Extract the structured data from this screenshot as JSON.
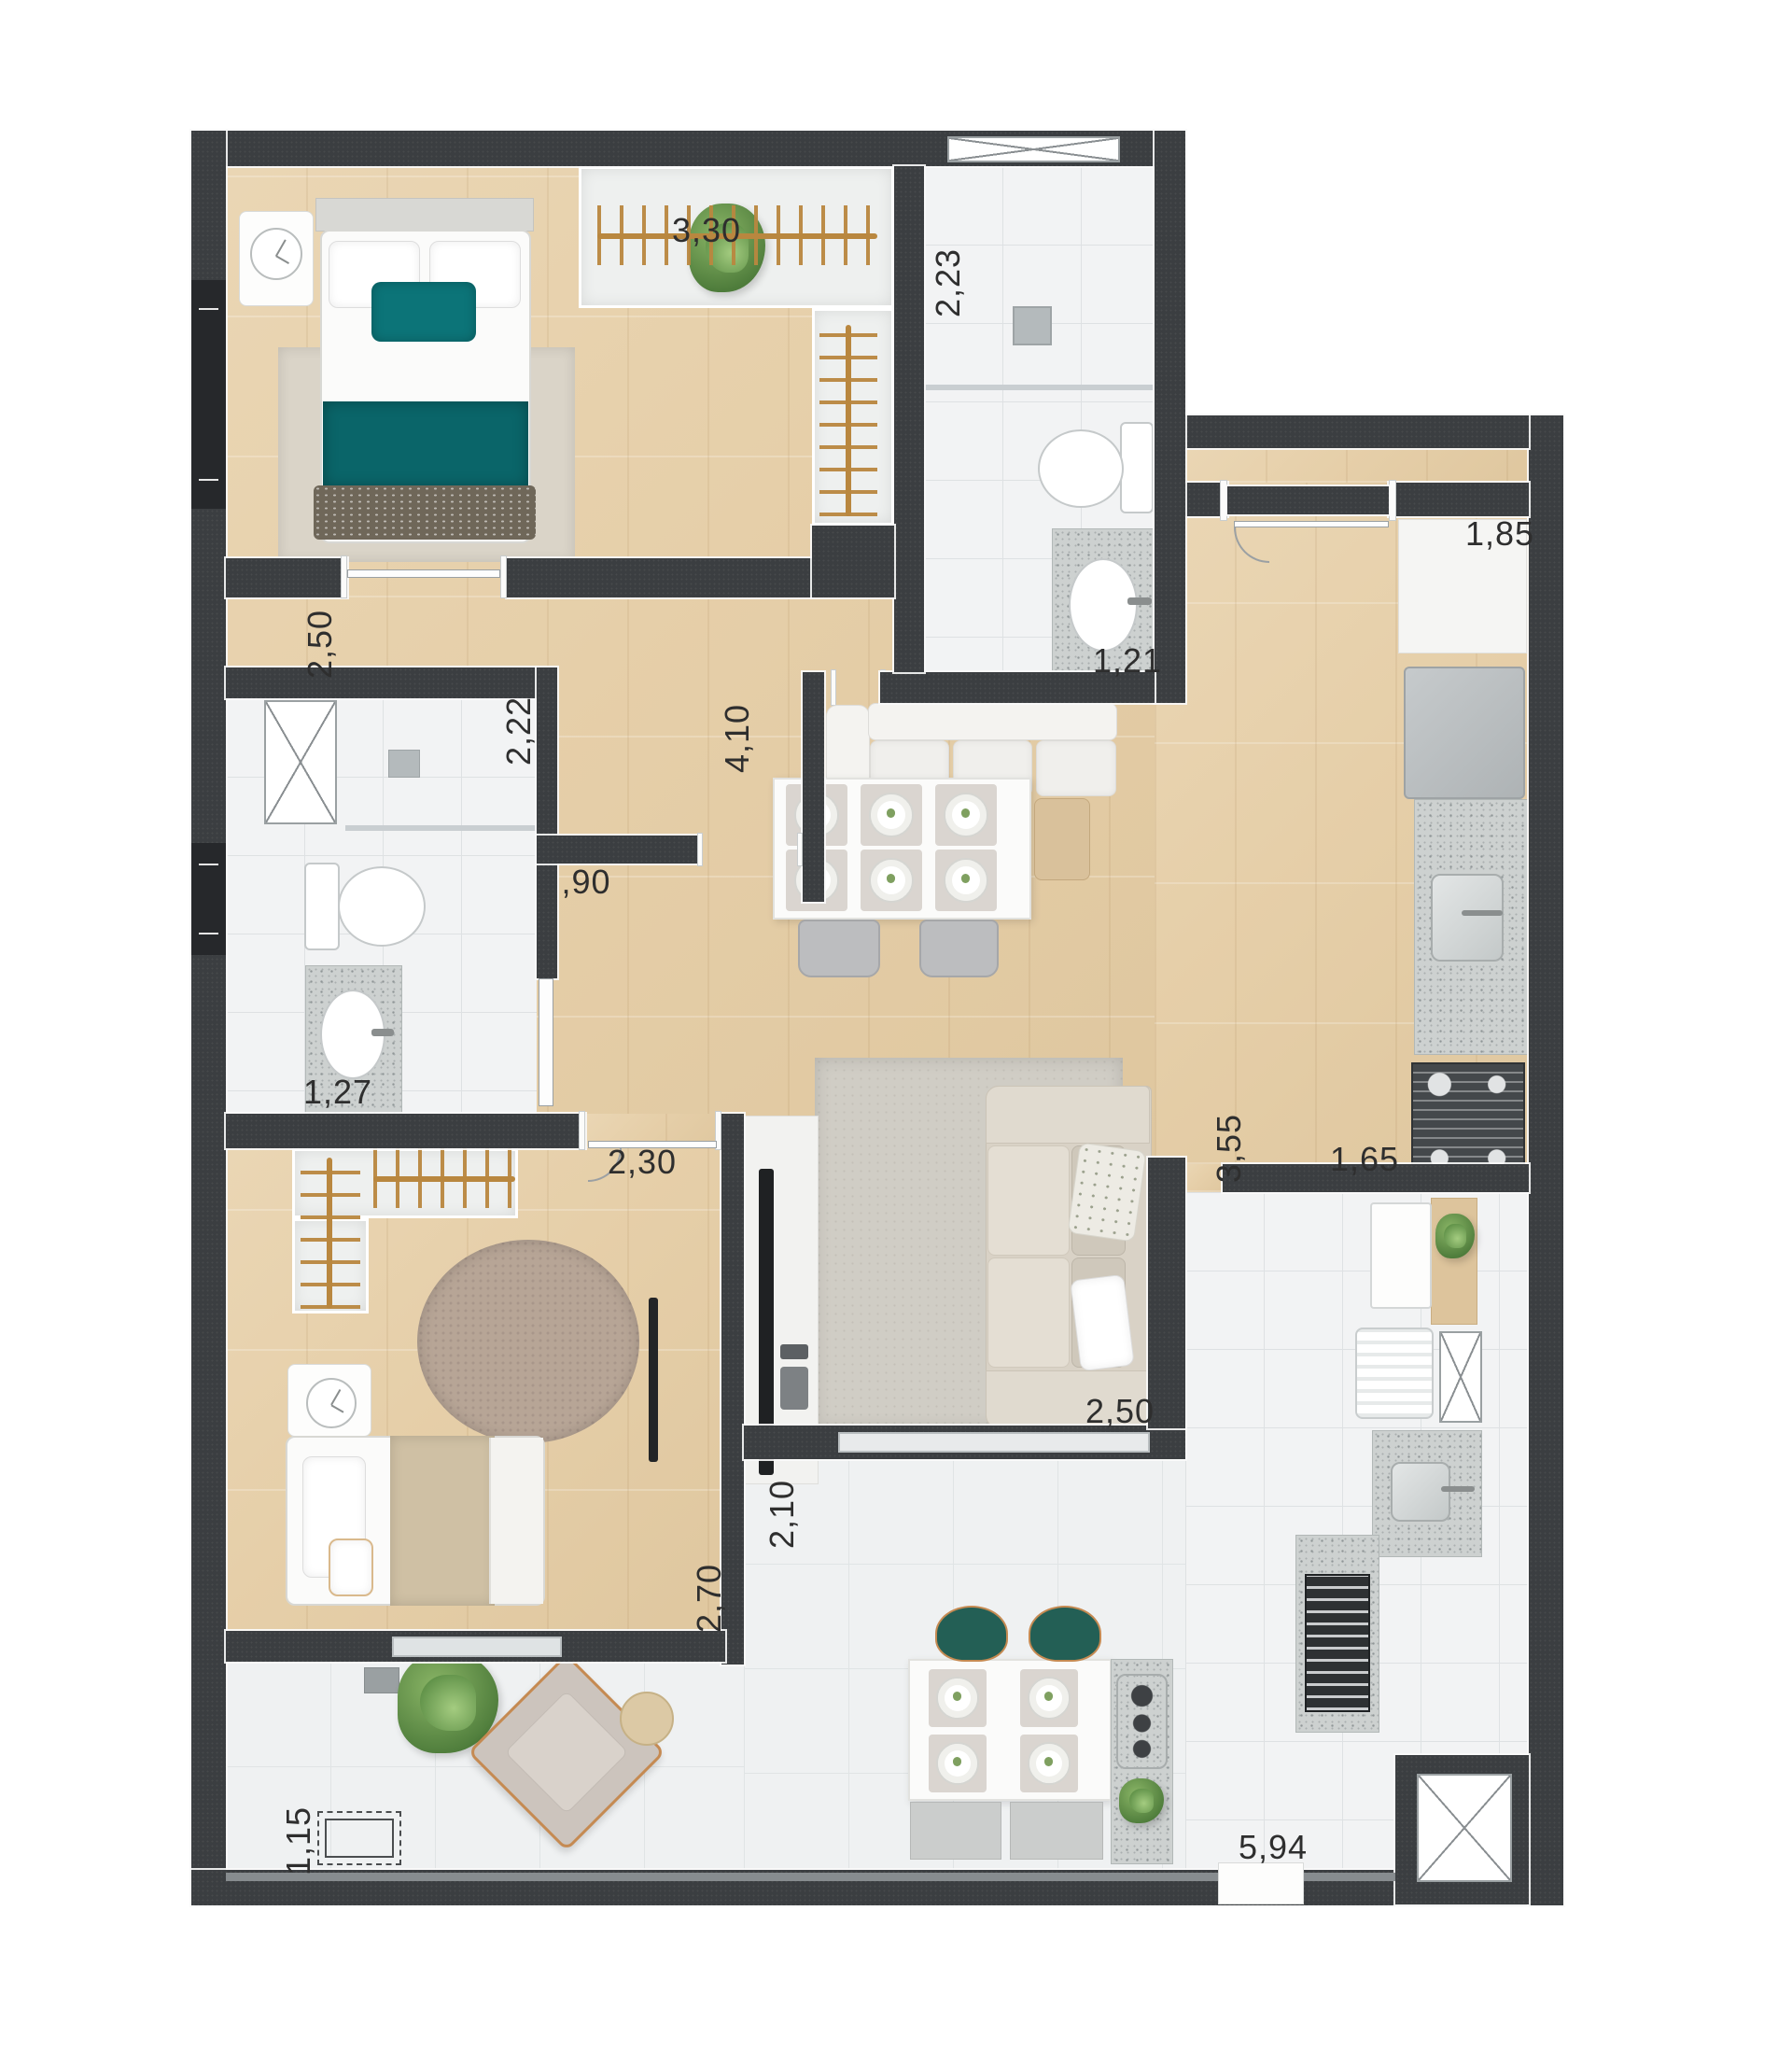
{
  "title": "Apartment floor plan (top view render)",
  "colors": {
    "wall": "#3b3e41",
    "wood": "#ead6b4",
    "wood2": "#dfc79f",
    "tile": "#f2f3f4",
    "teal": "#0c7478",
    "granite": "#c9cdcc",
    "rug": "#d0cdc5",
    "sofa": "#d9d2c6",
    "rod": "#b9873f",
    "green": "#5f8f4a"
  },
  "labels": {
    "bedroom1_width": "3,30",
    "suite_bath_depth": "2,23",
    "bedroom1_depth": "2,50",
    "suite_vanity_width": "1,21",
    "kitchen_counter_width": "1,85",
    "bath2_depth": "2,22",
    "hall_passage_width": ",90",
    "dining_depth": "4,10",
    "bath2_vanity_width": "1,27",
    "bedroom2_width": "2,30",
    "kitchen_depth": "3,55",
    "kitchen_width": "1,65",
    "living_width": "2,50",
    "balcony_depth": "2,10",
    "bedroom2_depth": "2,70",
    "balcony_left_width": "1,15",
    "balcony_width": "5,94"
  }
}
